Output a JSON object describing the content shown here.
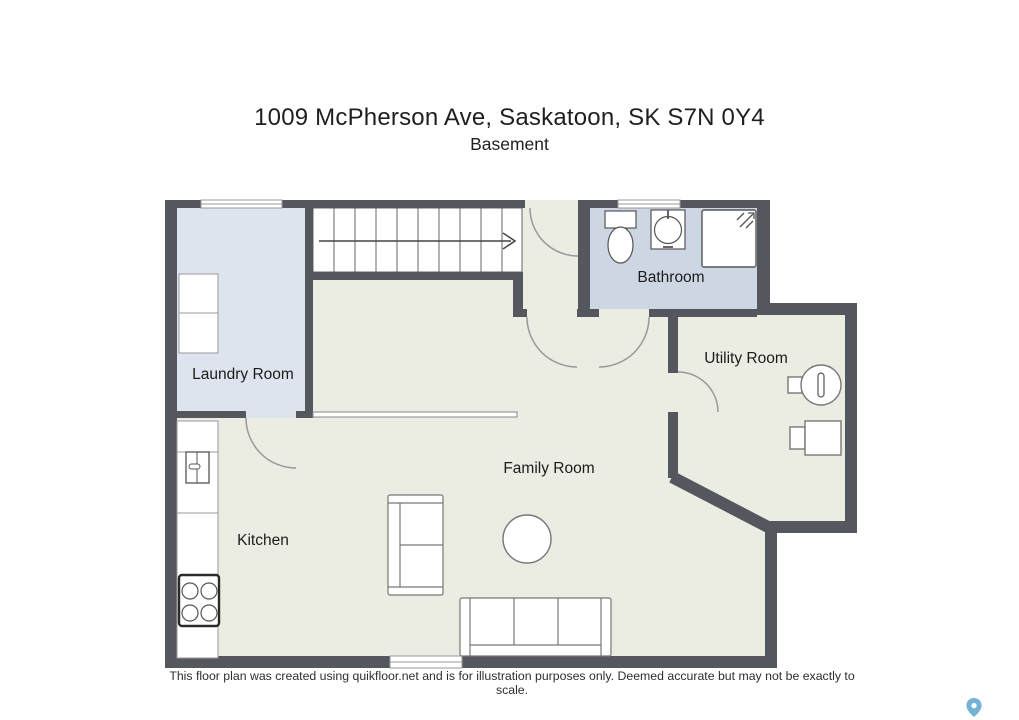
{
  "title": "1009 McPherson Ave, Saskatoon, SK S7N 0Y4",
  "subtitle": "Basement",
  "rooms": {
    "laundry": {
      "label": "Laundry Room"
    },
    "bathroom": {
      "label": "Bathroom"
    },
    "utility": {
      "label": "Utility Room"
    },
    "family": {
      "label": "Family Room"
    },
    "kitchen": {
      "label": "Kitchen"
    }
  },
  "footer": "This floor plan was created using quikfloor.net and is for illustration purposes only. Deemed accurate but may not be exactly to scale.",
  "colors": {
    "wall": "#54585e",
    "floor": "#ebece2",
    "laundry_floor": "#dee4ee",
    "bathroom_floor": "#cdd7e4",
    "fixture_outline": "#777777",
    "door_arc": "#999999",
    "stairs_arrow": "#444444",
    "map_pin": "#74b3d3",
    "text": "#1f1f1f"
  },
  "icons": {
    "stairs_direction": "arrow-right",
    "watermark": "map-pin"
  }
}
